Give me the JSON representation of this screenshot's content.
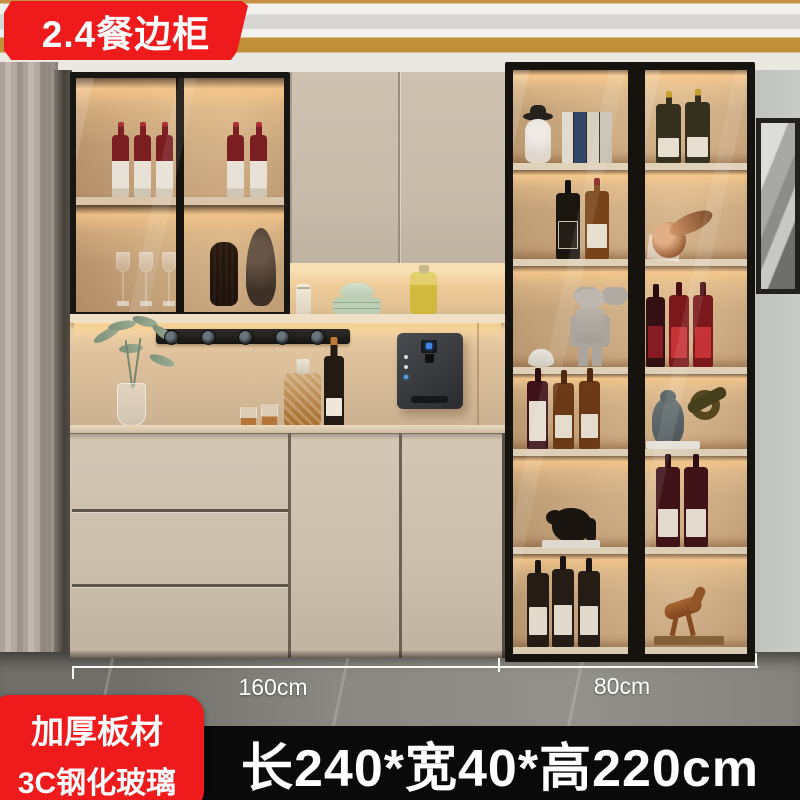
{
  "title_badge": {
    "label": "2.4餐边柜"
  },
  "feature_badge": {
    "line1": "加厚板材",
    "line2": "3C钢化玻璃"
  },
  "size_banner": {
    "label": "长240*宽40*高220cm"
  },
  "measurements": {
    "left_section": "160cm",
    "right_section": "80cm"
  },
  "colors": {
    "accent_red": "#ee1a1c",
    "banner_black": "#0a0a0a",
    "cabinet_beige": "#c9bcab",
    "frame_black": "#15130f",
    "led_glow": "#ffd898",
    "ceiling_gold": "#c09138",
    "floor_gray": "#85837d",
    "text_white": "#ffffff"
  }
}
